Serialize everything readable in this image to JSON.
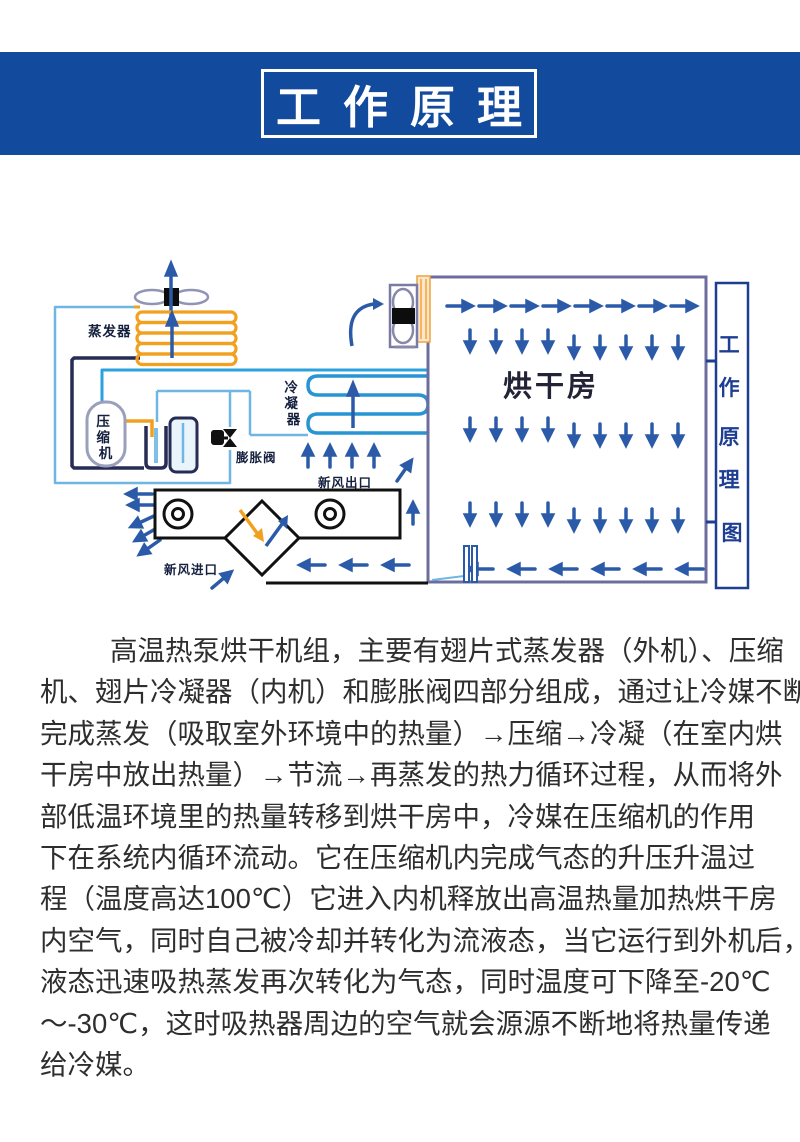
{
  "header": {
    "title": "工作原理",
    "band_color": "#124a9e",
    "title_color": "#ffffff"
  },
  "diagram": {
    "labels": {
      "evaporator": "蒸发器",
      "compressor": "压缩机",
      "compressor_chars": [
        "压",
        "缩",
        "机"
      ],
      "condenser": "冷凝器",
      "condenser_chars": [
        "冷",
        "凝",
        "器"
      ],
      "expansion_valve": "膨胀阀",
      "fresh_air_outlet": "新风出口",
      "fresh_air_inlet": "新风进口",
      "drying_room": "烘干房",
      "side_caption": "工作原理图",
      "side_caption_chars": [
        "工",
        "作",
        "原",
        "理",
        "图"
      ]
    },
    "colors": {
      "arrow_blue": "#2b5ba8",
      "pipe_light_blue": "#6fb6e4",
      "pipe_cyan": "#2ba2de",
      "pipe_navy": "#272c55",
      "coil_blue": "#2795d3",
      "coil_orange": "#f1a11f",
      "wall_gray": "#6c6c9e",
      "caption_blue": "#1e3e92"
    }
  },
  "paragraph": {
    "lines": [
      "高温热泵烘干机组，主要有翅片式蒸发器（外机）、压缩",
      "机、翅片冷凝器（内机）和膨胀阀四部分组成，通过让冷媒不断",
      "完成蒸发（吸取室外环境中的热量）→压缩→冷凝（在室内烘",
      "干房中放出热量）→节流→再蒸发的热力循环过程，从而将外",
      "部低温环境里的热量转移到烘干房中，冷媒在压缩机的作用",
      "下在系统内循环流动。它在压缩机内完成气态的升压升温过",
      "程（温度高达100℃）它进入内机释放出高温热量加热烘干房",
      "内空气，同时自己被冷却并转化为流液态，当它运行到外机后，",
      "液态迅速吸热蒸发再次转化为气态，同时温度可下降至-20℃",
      "～-30℃，这时吸热器周边的空气就会源源不断地将热量传递",
      "给冷媒。"
    ]
  }
}
